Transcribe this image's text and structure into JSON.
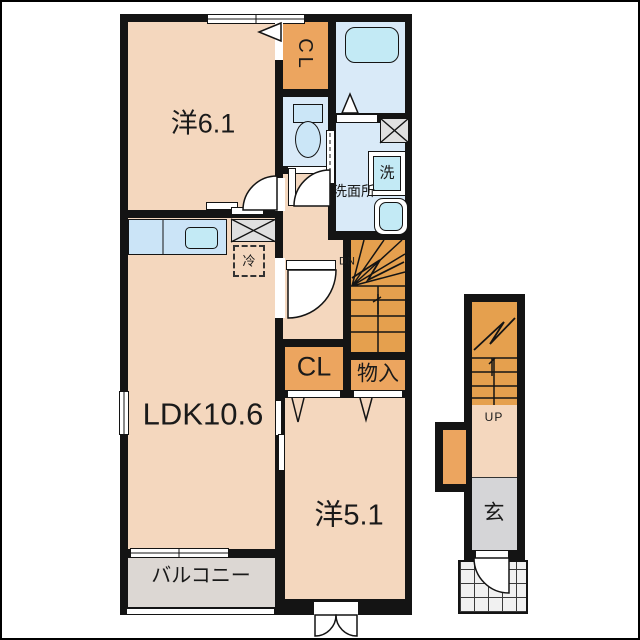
{
  "plan_type": "apartment-floor-plan",
  "labels": {
    "bedroom1": "洋6.1",
    "closet1": "CL",
    "washroom": "洗面所",
    "washer": "洗",
    "refrigerator": "冷",
    "stairs_down": "DN",
    "ldk": "LDK10.6",
    "closet2": "CL",
    "storage": "物入",
    "bedroom2": "洋5.1",
    "balcony": "バルコニー",
    "stairs_up": "UP",
    "entrance": "玄"
  },
  "colors": {
    "wall": "#141414",
    "room_peach": "#F4D7BE",
    "closet_orange": "#ECA55F",
    "stairs_orange": "#E5A04E",
    "wet_blue": "#D9EAF8",
    "fixture_cyan": "#C3EAF5",
    "counter_blue": "#CBE4F7",
    "balcony_gray": "#DCD7D3",
    "entrance_gray": "#D5D5D7",
    "shaft_gray": "#E0E0E0"
  }
}
